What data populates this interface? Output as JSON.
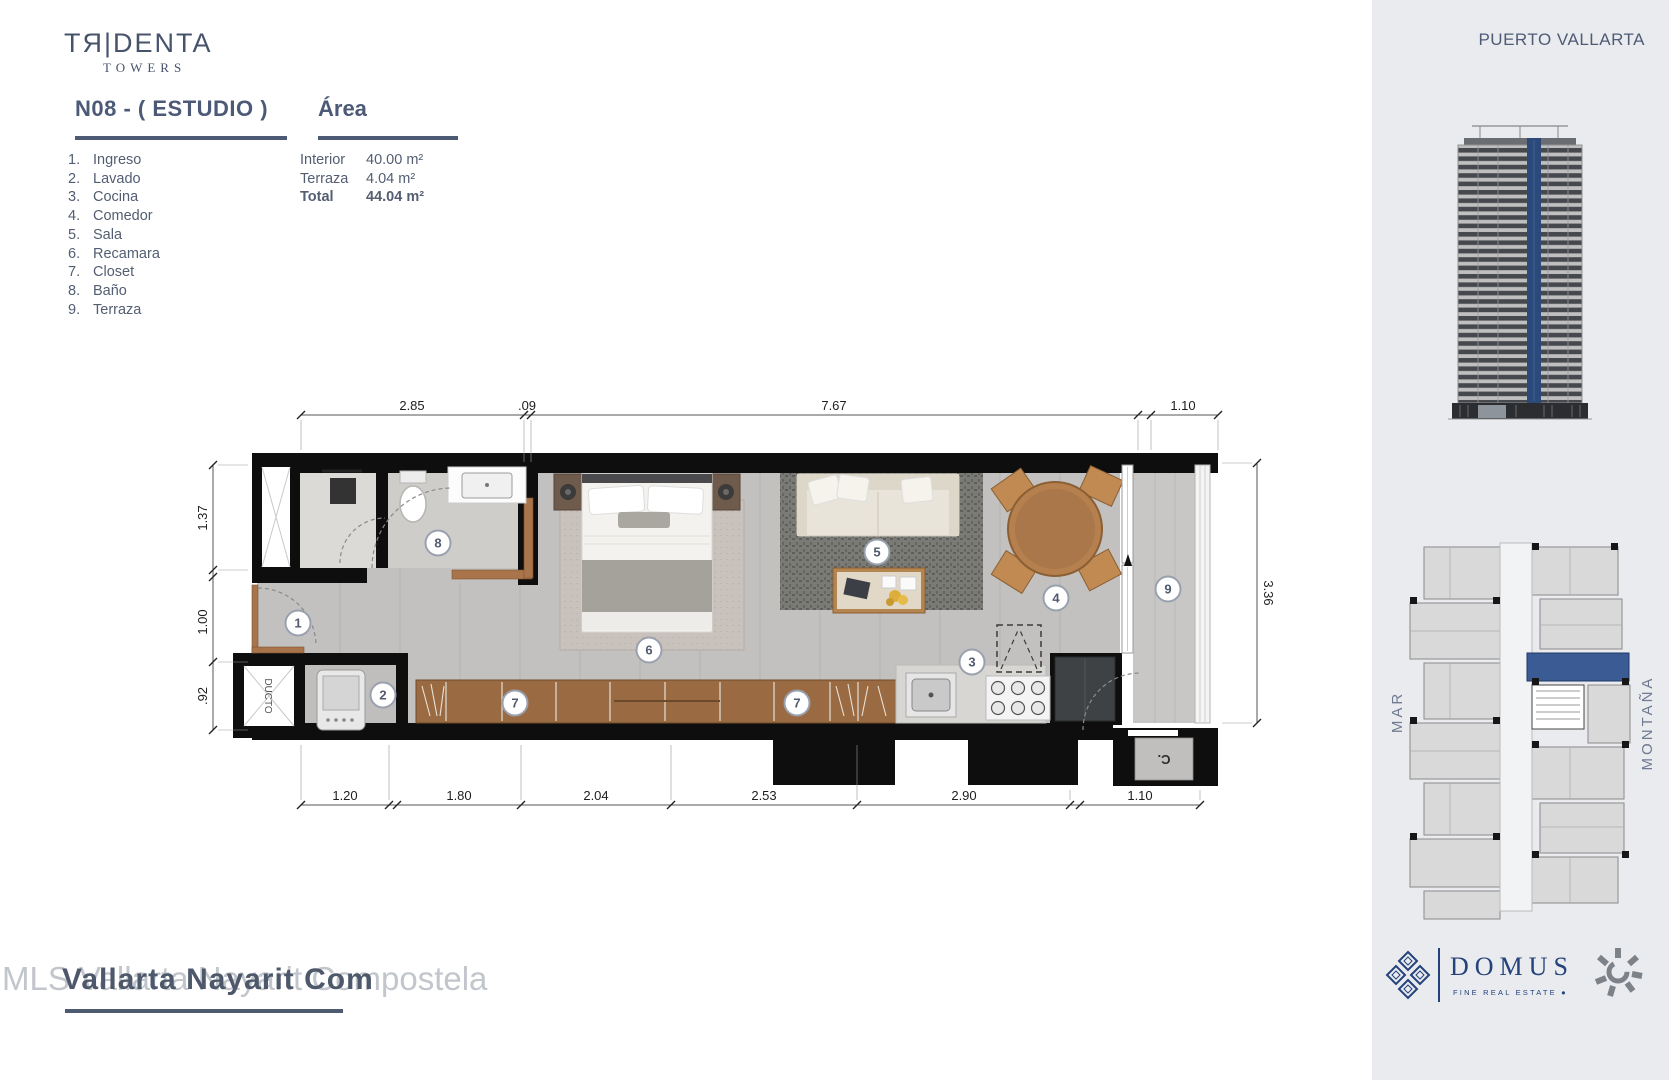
{
  "brand": {
    "name": "TЯ|DENTA",
    "sub": "TOWERS"
  },
  "location": "PUERTO VALLARTA",
  "unit": {
    "title": "N08 - ( ESTUDIO )",
    "area_heading": "Área"
  },
  "legend": [
    {
      "num": "1.",
      "label": "Ingreso"
    },
    {
      "num": "2.",
      "label": "Lavado"
    },
    {
      "num": "3.",
      "label": "Cocina"
    },
    {
      "num": "4.",
      "label": "Comedor"
    },
    {
      "num": "5.",
      "label": "Sala"
    },
    {
      "num": "6.",
      "label": "Recamara"
    },
    {
      "num": "7.",
      "label": "Closet"
    },
    {
      "num": "8.",
      "label": "Baño"
    },
    {
      "num": "9.",
      "label": "Terraza"
    }
  ],
  "areas": [
    {
      "label": "Interior",
      "value": "40.00 m²"
    },
    {
      "label": "Terraza",
      "value": "4.04 m²"
    },
    {
      "label": "Total",
      "value": "44.04 m²"
    }
  ],
  "plan": {
    "dims_top": [
      "2.85",
      ".09",
      "7.67",
      "1.10"
    ],
    "dims_bottom": [
      "1.20",
      "1.80",
      "2.04",
      "2.53",
      "2.90",
      "1.10"
    ],
    "dims_left": [
      "1.37",
      "1.00",
      ".92"
    ],
    "dims_right": [
      "3.36"
    ],
    "markers": [
      "1",
      "2",
      "3",
      "4",
      "5",
      "6",
      "7",
      "7",
      "8",
      "9"
    ],
    "ducto": "DUCTO",
    "closet": "C."
  },
  "sidebar": {
    "mar": "MAR",
    "montana": "MONTAÑA"
  },
  "domus": {
    "name": "DOMUS",
    "tagline": "FINE REAL ESTATE",
    "dot": "●"
  },
  "footer": {
    "light": "MLS Vallarta Nayarit Compostela",
    "dark": "Vallarta Nayarit Com"
  },
  "colors": {
    "accent_blue": "#2c4a79",
    "wall_black": "#0e0e0e",
    "text": "#535e74"
  }
}
